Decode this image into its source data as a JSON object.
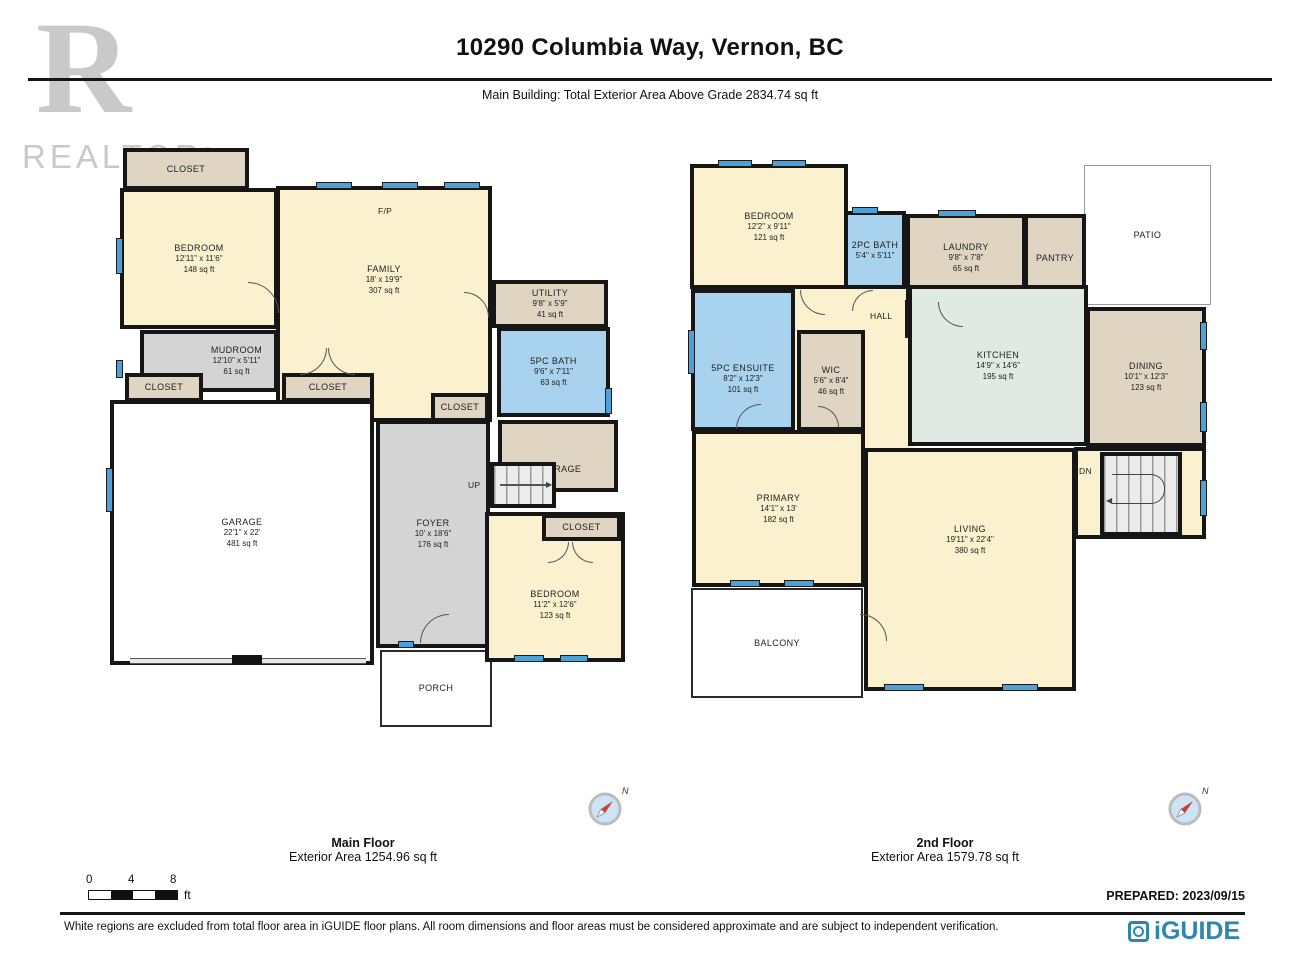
{
  "header": {
    "title": "10290 Columbia Way, Vernon, BC",
    "subtitle": "Main Building: Total Exterior Area Above Grade 2834.74 sq ft"
  },
  "watermark": {
    "letter": "R",
    "label": "REALTOR",
    "reg": "®"
  },
  "floors": {
    "main": {
      "caption": "Main Floor",
      "area_caption": "Exterior Area 1254.96 sq ft",
      "rooms": {
        "closet_top": {
          "name": "CLOSET"
        },
        "bedroom1": {
          "name": "BEDROOM",
          "dims": "12'11\" x 11'6\"",
          "area": "148 sq ft"
        },
        "family": {
          "name": "FAMILY",
          "dims": "18' x 19'9\"",
          "area": "307 sq ft"
        },
        "fp": {
          "name": "F/P"
        },
        "utility": {
          "name": "UTILITY",
          "dims": "9'8\" x 5'9\"",
          "area": "41 sq ft"
        },
        "bath5": {
          "name": "5PC BATH",
          "dims": "9'6\" x 7'11\"",
          "area": "63 sq ft"
        },
        "mudroom": {
          "name": "MUDROOM",
          "dims": "12'10\" x 5'11\"",
          "area": "61 sq ft"
        },
        "closet_left": {
          "name": "CLOSET"
        },
        "closet_mid": {
          "name": "CLOSET"
        },
        "closet_foyer": {
          "name": "CLOSET"
        },
        "storage": {
          "name": "STORAGE"
        },
        "stairs_up": {
          "name": "UP"
        },
        "garage": {
          "name": "GARAGE",
          "dims": "22'1\" x 22'",
          "area": "481 sq ft"
        },
        "foyer": {
          "name": "FOYER",
          "dims": "10' x 18'6\"",
          "area": "176 sq ft"
        },
        "closet_bed2": {
          "name": "CLOSET"
        },
        "bedroom2": {
          "name": "BEDROOM",
          "dims": "11'2\" x 12'6\"",
          "area": "123 sq ft"
        },
        "porch": {
          "name": "PORCH"
        }
      }
    },
    "second": {
      "caption": "2nd Floor",
      "area_caption": "Exterior Area 1579.78 sq ft",
      "rooms": {
        "bedroom": {
          "name": "BEDROOM",
          "dims": "12'2\" x 9'11\"",
          "area": "121 sq ft"
        },
        "bath2": {
          "name": "2PC BATH",
          "dims": "5'4\" x 5'11\""
        },
        "laundry": {
          "name": "LAUNDRY",
          "dims": "9'8\" x 7'8\"",
          "area": "65 sq ft"
        },
        "pantry": {
          "name": "PANTRY"
        },
        "patio": {
          "name": "PATIO"
        },
        "hall": {
          "name": "HALL"
        },
        "clo": {
          "name": "CLO"
        },
        "ensuite": {
          "name": "5PC ENSUITE",
          "dims": "8'2\" x 12'3\"",
          "area": "101 sq ft"
        },
        "wic": {
          "name": "WIC",
          "dims": "5'6\" x 8'4\"",
          "area": "46 sq ft"
        },
        "kitchen": {
          "name": "KITCHEN",
          "dims": "14'9\" x 14'6\"",
          "area": "195 sq ft"
        },
        "dining": {
          "name": "DINING",
          "dims": "10'1\" x 12'3\"",
          "area": "123 sq ft"
        },
        "stairs_dn": {
          "name": "DN"
        },
        "primary": {
          "name": "PRIMARY",
          "dims": "14'1\" x 13'",
          "area": "182 sq ft"
        },
        "living": {
          "name": "LIVING",
          "dims": "19'11\" x 22'4\"",
          "area": "380 sq ft"
        },
        "balcony": {
          "name": "BALCONY"
        }
      }
    }
  },
  "compass": {
    "north": "N"
  },
  "scale": {
    "ticks": [
      "0",
      "4",
      "8"
    ],
    "unit": "ft"
  },
  "prepared": "PREPARED: 2023/09/15",
  "footer": {
    "disclaimer": "White regions are excluded from total floor area in iGUIDE floor plans. All room dimensions and floor areas must be considered approximate and are subject to independent verification.",
    "brand": "iGUIDE"
  },
  "colors": {
    "wall": "#161616",
    "room_cream": "#FBF1CE",
    "room_tan": "#DFD5C2",
    "room_gray": "#D4D4D4",
    "room_blue": "#A8D2EE",
    "room_kitchen": "#E0EAE2",
    "window_blue": "#4BA1D8",
    "brand_blue": "#2E85AD",
    "watermark_gray": "#C9C9C9"
  }
}
